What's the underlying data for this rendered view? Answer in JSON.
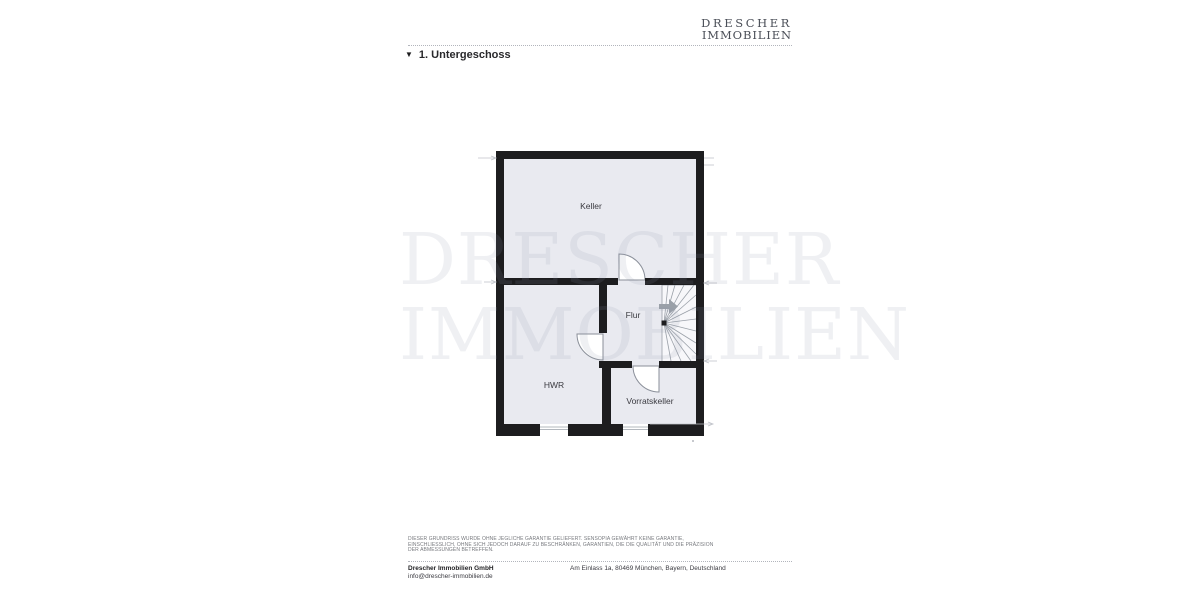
{
  "header": {
    "logo_line1": "DRESCHER",
    "logo_line2": "IMMOBILIEN"
  },
  "section": {
    "marker": "▼",
    "title": "1. Untergeschoss"
  },
  "floorplan": {
    "rooms": [
      {
        "id": "keller",
        "label": "Keller"
      },
      {
        "id": "flur",
        "label": "Flur"
      },
      {
        "id": "hwr",
        "label": "HWR"
      },
      {
        "id": "vorratskeller",
        "label": "Vorratskeller"
      }
    ],
    "features": [
      "winder-staircase",
      "stairs-direction-arrow",
      "3 doors",
      "2 windows"
    ],
    "colors": {
      "wall": "#1d1d1f",
      "room_fill": "#e9eaf0",
      "stair_fill": "#f7f7fa",
      "line_gray": "#9aa0a8",
      "arrow": "#9aa0a8"
    }
  },
  "watermark": {
    "line1": "DRESCHER",
    "line2": "IMMOBILIEN"
  },
  "disclaimer": {
    "line1": "Dieser Grundriss wurde ohne jegliche Garantie geliefert. Sensopia gewährt keine Garantie,",
    "line2": "einschliesslich, ohne sich jedoch darauf zu beschränken, Garantien, die die Qualität und die Präzision",
    "line3": "der Abmessungen betreffen."
  },
  "footer": {
    "company": "Drescher Immobilien GmbH",
    "email": "info@drescher-immobilien.de",
    "address": "Am Einlass 1a, 80469 München, Bayern, Deutschland"
  }
}
